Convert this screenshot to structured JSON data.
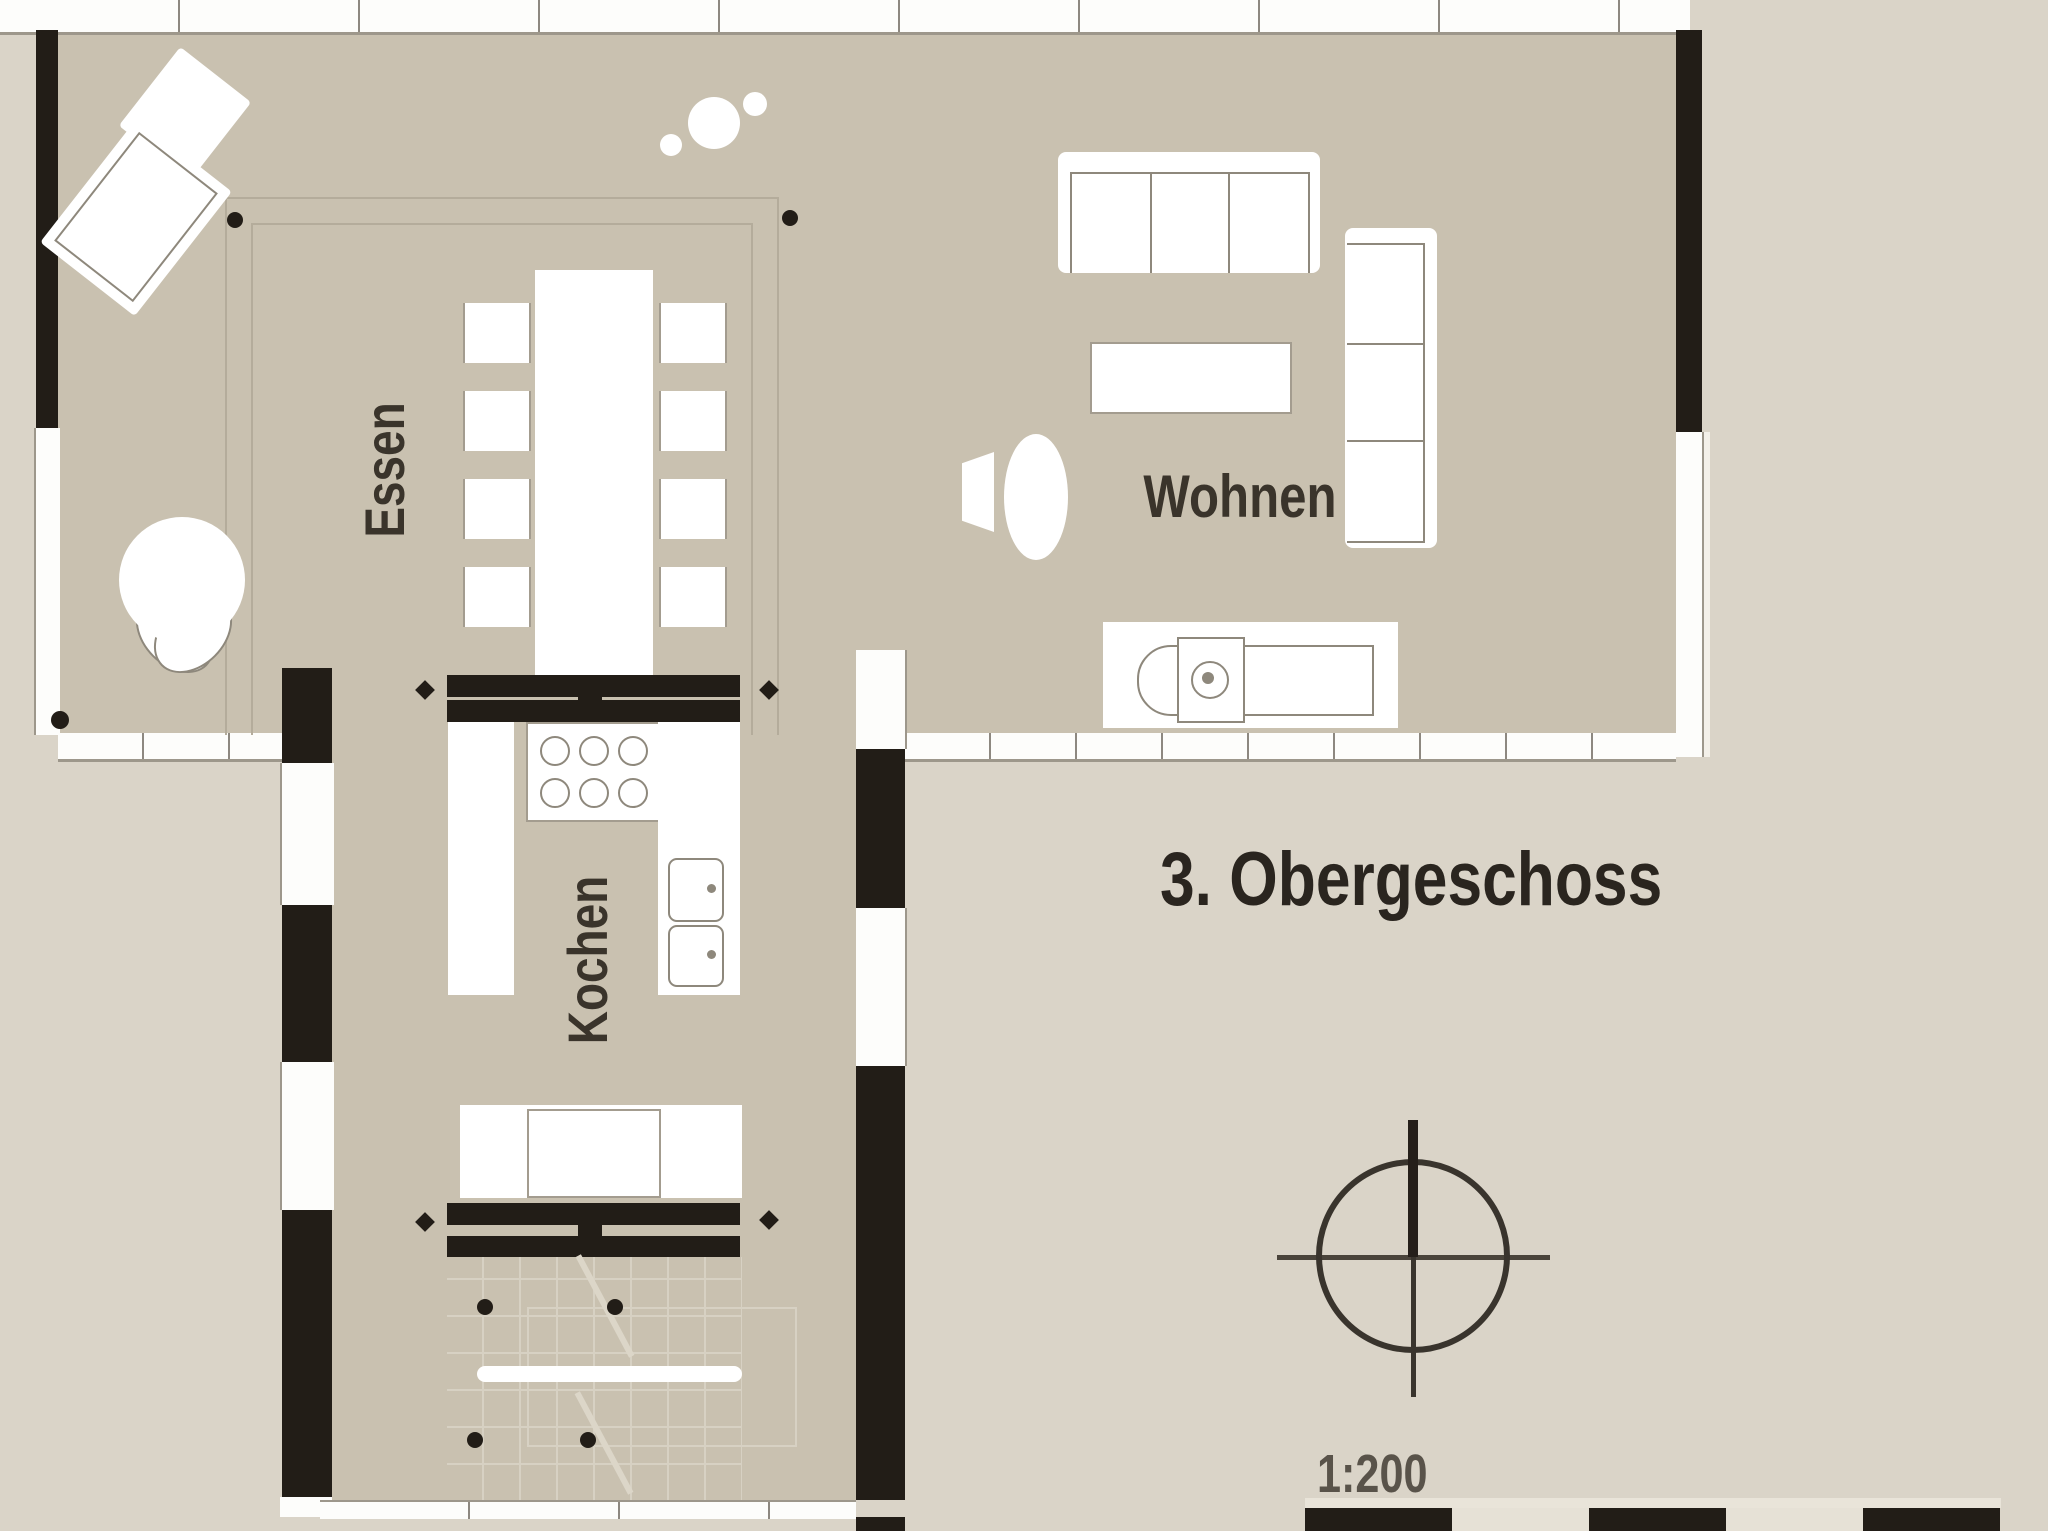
{
  "title": "3. Obergeschoss",
  "scale_label": "1:200",
  "rooms": {
    "dining": "Essen",
    "kitchen": "Kochen",
    "living": "Wohnen"
  },
  "colors": {
    "background": "#dad4c8",
    "floor": "#c9c1b0",
    "wall_black": "#221d17",
    "furniture_white": "#ffffff",
    "furniture_outline": "#8e887c",
    "scale_bar_light": "#e6e1d6",
    "text": "#3a342b"
  },
  "scale_bar": {
    "segments": [
      "black",
      "light",
      "black",
      "light",
      "black"
    ]
  },
  "icons": {
    "north_indicator": "crosshair-circle-north-arrow"
  }
}
